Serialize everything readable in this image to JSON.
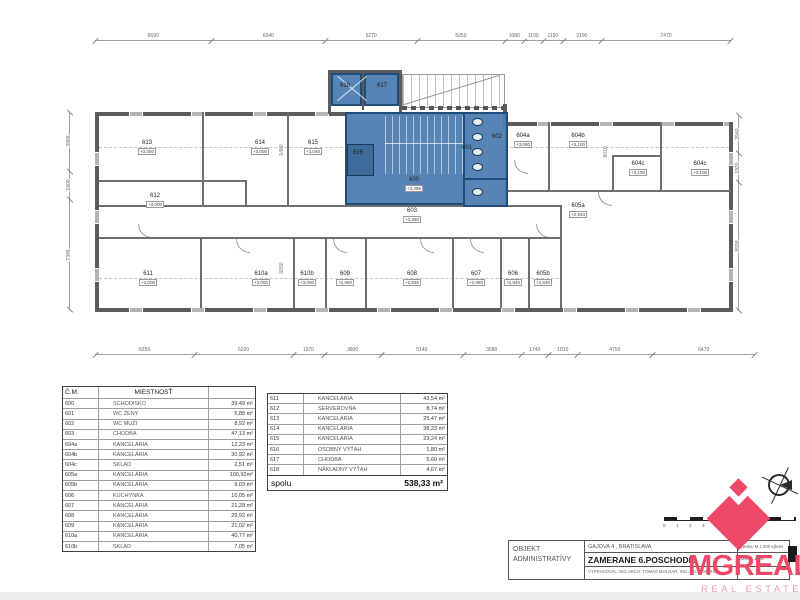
{
  "sheet": {
    "title_block": {
      "owner_line1": "OBJEKT",
      "owner_line2": "ADMINISTRATÍVY",
      "address": "GAJOVA 4 , BRATISLAVA",
      "drawing_title": "ZAMERANE 6.POSCHODIE",
      "author": "VYPRACOVAL: ING.ARCH. TOMÁŠ MOLNÁR, ING.ARCH. MÁRIA",
      "scale_label": "mierka: M 1:200 výkres",
      "format_label": "formát: 1xA4"
    },
    "logo": {
      "wordmark": "MGREAL",
      "tagline": "REAL ESTATE",
      "color": "#ee4868"
    },
    "accent_blue": "#487aaf",
    "wall_gray": "#5c5c5c"
  },
  "dimensions": {
    "top": [
      "6690",
      "6540",
      "5270",
      "5050",
      "1080",
      "1100",
      "1150",
      "2190",
      "7470"
    ],
    "bottom": [
      "6259",
      "6220",
      "1970",
      "3600",
      "5140",
      "3680",
      "1740",
      "1810",
      "4750",
      "6470"
    ],
    "left": [
      "3886",
      "1900",
      "7349"
    ],
    "right": [
      "2540",
      "1920",
      "8590"
    ],
    "interior": [
      {
        "v": "5480",
        "x": 282,
        "y": 150
      },
      {
        "v": "8850",
        "x": 282,
        "y": 268
      },
      {
        "v": "9010",
        "x": 606,
        "y": 152
      }
    ]
  },
  "plan_rooms": [
    {
      "id": "613",
      "elev": "+3,060",
      "x": 147,
      "y": 140
    },
    {
      "id": "614",
      "elev": "+3,000",
      "x": 260,
      "y": 140
    },
    {
      "id": "615",
      "elev": "+3,040",
      "x": 313,
      "y": 140
    },
    {
      "id": "612",
      "elev": "+3,000",
      "x": 155,
      "y": 193
    },
    {
      "id": "611",
      "elev": "+3,000",
      "x": 148,
      "y": 271
    },
    {
      "id": "610a",
      "elev": "+3,000",
      "x": 261,
      "y": 271
    },
    {
      "id": "610b",
      "elev": "+3,000",
      "x": 307,
      "y": 271
    },
    {
      "id": "609",
      "elev": "+2,980",
      "x": 345,
      "y": 271
    },
    {
      "id": "608",
      "elev": "+2,835",
      "x": 412,
      "y": 271
    },
    {
      "id": "607",
      "elev": "+2,980",
      "x": 476,
      "y": 271
    },
    {
      "id": "606",
      "elev": "+2,940",
      "x": 513,
      "y": 271
    },
    {
      "id": "605b",
      "elev": "+2,940",
      "x": 543,
      "y": 271
    },
    {
      "id": "605a",
      "elev": "+2,940",
      "x": 578,
      "y": 203
    },
    {
      "id": "604a",
      "elev": "+3,080",
      "x": 523,
      "y": 133
    },
    {
      "id": "604b",
      "elev": "+3,100",
      "x": 578,
      "y": 133
    },
    {
      "id": "604c",
      "elev": "+3,100",
      "x": 638,
      "y": 161
    },
    {
      "id": "604c",
      "elev": "+3,100",
      "x": 700,
      "y": 161
    },
    {
      "id": "600",
      "elev": "+3,385",
      "x": 414,
      "y": 177
    },
    {
      "id": "603",
      "elev": "+3,380",
      "x": 412,
      "y": 208
    },
    {
      "id": "601",
      "elev": "",
      "x": 467,
      "y": 145
    },
    {
      "id": "602",
      "elev": "",
      "x": 497,
      "y": 134
    },
    {
      "id": "616",
      "elev": "",
      "x": 358,
      "y": 150
    },
    {
      "id": "617",
      "elev": "",
      "x": 382,
      "y": 83
    },
    {
      "id": "618",
      "elev": "",
      "x": 345,
      "y": 83
    }
  ],
  "room_table_left": {
    "headers": [
      "Č.M.",
      "MIESTNOSŤ",
      ""
    ],
    "rows": [
      [
        "600",
        "SCHODISKO",
        "39,49 m²"
      ],
      [
        "601",
        "WC ŽENY",
        "5,88 m²"
      ],
      [
        "602",
        "WC MUŽI",
        "8,92 m²"
      ],
      [
        "603",
        "CHODBA",
        "47,13 m²"
      ],
      [
        "604a",
        "KANCELÁRIA",
        "12,23 m²"
      ],
      [
        "604b",
        "KANCELÁRIA",
        "30,92 m²"
      ],
      [
        "604c",
        "SKLAD",
        "2,51 m²"
      ],
      [
        "605a",
        "KANCELÁRIA",
        "100,92m²"
      ],
      [
        "605b",
        "KANCELÁRIA",
        "9,03 m²"
      ],
      [
        "606",
        "KUCHYNKA",
        "10,05 m²"
      ],
      [
        "607",
        "KANCELÁRIA",
        "21,28 m²"
      ],
      [
        "608",
        "KANCELÁRIA",
        "29,92 m²"
      ],
      [
        "609",
        "KANCELÁRIA",
        "21,02 m²"
      ],
      [
        "610a",
        "KANCELÁRIA",
        "40,77 m²"
      ],
      [
        "610b",
        "SKLAD",
        "7,05 m²"
      ]
    ]
  },
  "room_table_right": {
    "rows": [
      [
        "611",
        "KANCELÁRIA",
        "43,54 m²"
      ],
      [
        "612",
        "SERVEROVŇA",
        "8,74 m²"
      ],
      [
        "613",
        "KANCELÁRIA",
        "25,47 m²"
      ],
      [
        "614",
        "KANCELÁRIA",
        "38,23 m²"
      ],
      [
        "615",
        "KANCELÁRIA",
        "23,24 m²"
      ],
      [
        "616",
        "OSOBNÝ VÝŤAH",
        "1,80 m²"
      ],
      [
        "617",
        "CHODBA",
        "5,60 m²"
      ],
      [
        "618",
        "NÁKLADNÝ VÝŤAH",
        "4,67 m²"
      ]
    ],
    "total_label": "spolu",
    "total_value": "538,33 m²"
  },
  "scale_marks": [
    "0",
    "1",
    "2",
    "3"
  ]
}
